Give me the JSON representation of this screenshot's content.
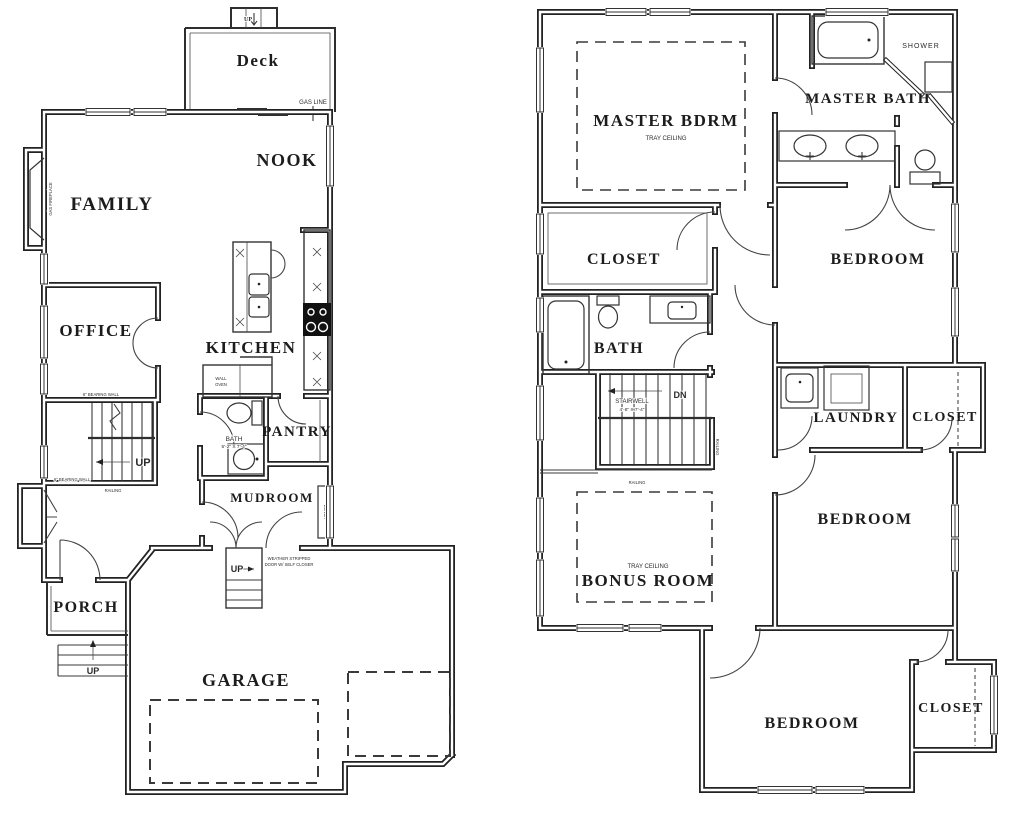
{
  "first_floor": {
    "rooms": {
      "deck": "Deck",
      "nook": "NOOK",
      "family": "FAMILY",
      "office": "OFFICE",
      "kitchen": "KITCHEN",
      "pantry": "PANTRY",
      "bath": "BATH",
      "mudroom": "MUDROOM",
      "porch": "PORCH",
      "garage": "GARAGE"
    },
    "dims": {
      "bath": "5'-2\" X 7'-4\""
    },
    "annotations": {
      "deck_up": "UP",
      "gas_line": "GAS LINE",
      "gas_fireplace": "GAS FIREPLACE",
      "bearing_wall_upper": "6\" BEARING WALL",
      "bearing_wall_lower": "6\" BEARING WALL",
      "wall_oven_line1": "WALL",
      "wall_oven_line2": "OVEN",
      "bench": "BENCH",
      "stairs_up": "UP",
      "stairs_railing": "RAILING",
      "garage_stairs_up": "UP",
      "weather_line1": "WEATHER STRIPPED",
      "weather_line2": "DOOR W/ SELF CLOSER",
      "porch_steps_up": "UP"
    }
  },
  "second_floor": {
    "rooms": {
      "master_bdrm": "MASTER BDRM",
      "master_bath": "MASTER BATH",
      "shower": "SHOWER",
      "closet_master": "CLOSET",
      "bedroom_upper": "BEDROOM",
      "bath": "BATH",
      "laundry": "LAUNDRY",
      "closet_laundry": "CLOSET",
      "bedroom_middle": "BEDROOM",
      "bonus_room": "BONUS ROOM",
      "bedroom_lower": "BEDROOM",
      "closet_lower": "CLOSET"
    },
    "dims": {
      "stairwell": "4'-8\" X 7'-4\""
    },
    "annotations": {
      "tray_ceiling_master": "TRAY CEILING",
      "tray_ceiling_bonus": "TRAY CEILING",
      "stairwell": "STAIRWELL",
      "down": "DN",
      "railing_horizontal": "RAILING",
      "railing_vertical": "RAILING"
    }
  }
}
